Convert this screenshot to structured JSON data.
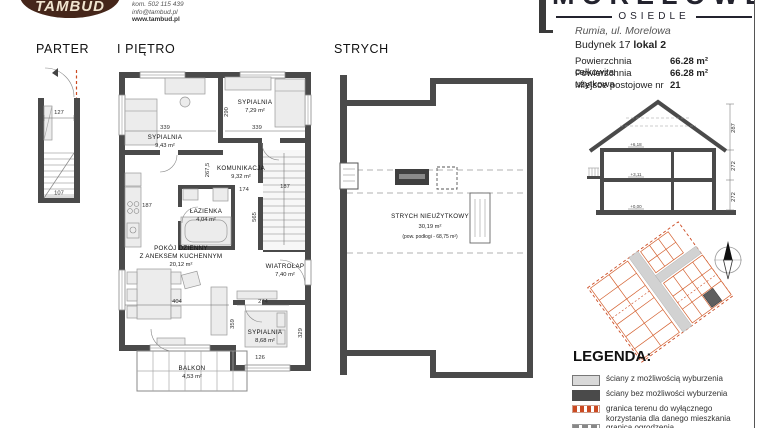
{
  "header": {
    "logo": "TAMBUD",
    "phone": "kom. 502 115 439",
    "email": "info@tambud.pl",
    "website": "www.tambud.pl"
  },
  "floors": {
    "parter": "PARTER",
    "pietro": "I PIĘTRO",
    "strych": "STRYCH"
  },
  "project": {
    "name": "MORELOWE",
    "estate": "OSIEDLE",
    "address": "Rumia, ul. Morelowa",
    "building": "Budynek 17",
    "unit": "lokal 2",
    "specs": [
      {
        "label": "Powierzchnia całkowita",
        "value": "66.28 m²"
      },
      {
        "label": "Powierzchnia użytkowa",
        "value": "66.28 m²"
      },
      {
        "label": "Miejsce postojowe nr",
        "value": "21"
      }
    ]
  },
  "parter_plan": {
    "dim_top": "127",
    "dim_bottom": "107"
  },
  "floor_plan": {
    "bedroom1": {
      "name": "SYPIALNIA",
      "area": "9,43 m²"
    },
    "bedroom2": {
      "name": "SYPIALNIA",
      "area": "7,29 m²"
    },
    "hall": {
      "name": "KOMUNIKACJA",
      "area": "9,32 m²"
    },
    "bathroom": {
      "name": "ŁAZIENKA",
      "area": "4,04 m²"
    },
    "living": {
      "line1": "POKÓJ DZIENNY",
      "line2": "Z ANEKSEM KUCHENNYM",
      "area": "20,12 m²"
    },
    "vestibule": {
      "name": "WIATROŁAP",
      "area": "7,40 m²"
    },
    "bedroom3": {
      "name": "SYPIALNIA",
      "area": "8,68 m²"
    },
    "balcony": {
      "name": "BALKON",
      "area": "4,53 m²"
    },
    "dims": {
      "w1": "339",
      "w2": "339",
      "h1": "290",
      "h2": "267,5",
      "w3": "174",
      "w4": "187",
      "w5": "187",
      "h3": "565",
      "w6": "404",
      "h4": "359",
      "w7": "274",
      "h5": "329",
      "w8": "126"
    }
  },
  "attic_plan": {
    "name": "STRYCH NIEUŻYTKOWY",
    "area": "30,19 m²",
    "note": "(pow. podłogi - 68,75 m²)"
  },
  "section": {
    "attic_h": "287",
    "floor1_h": "272",
    "floor0_h": "272",
    "level_top": "+6,18",
    "level_mid": "+3,11",
    "level_zero": "+0,00"
  },
  "legend": {
    "title": "LEGENDA:",
    "items": [
      {
        "label": "ściany z możliwością wyburzenia"
      },
      {
        "label": "ściany bez możliwości wyburzenia"
      },
      {
        "label": "granica terenu do wyłącznego korzystania dla danego mieszkania"
      },
      {
        "label": "granica ogrodzenia"
      }
    ]
  },
  "colors": {
    "wall_dark": "#4a4a4a",
    "wall_light": "#d9d9d9",
    "boundary_red": "#cc4a22",
    "logo_brown": "#45261a"
  }
}
